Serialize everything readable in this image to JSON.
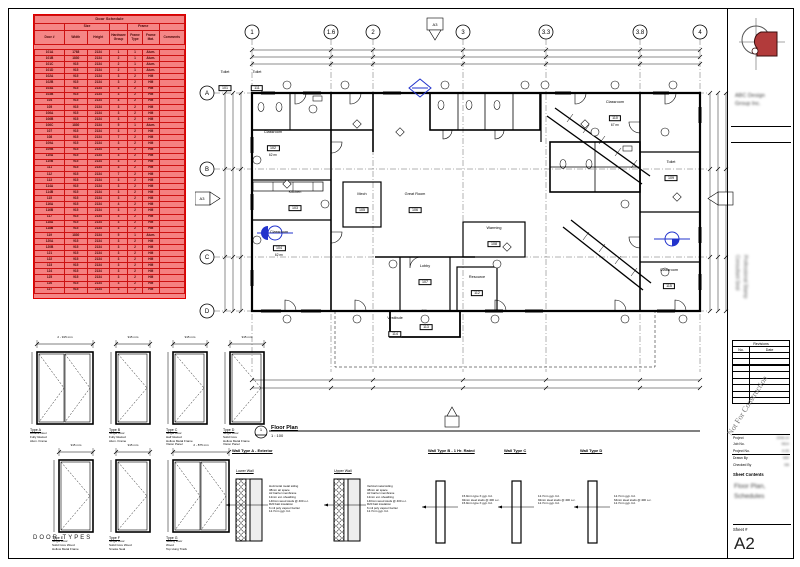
{
  "colors": {
    "schedule_fill": "#f58080",
    "schedule_border": "#e00000",
    "logo_red": "#b23b3b",
    "callout_blue": "#2233cc",
    "watermark_gray": "#777777"
  },
  "door_schedule": {
    "title": "Door Schedule",
    "groups": {
      "size": "Size",
      "frame": "Frame"
    },
    "columns": [
      "Door #",
      "Width",
      "Height",
      "Hardware Group",
      "Frame Type",
      "Frame Mat.",
      "Comments"
    ],
    "rows": [
      [
        "101A",
        "1768",
        "2134",
        "1",
        "1",
        "Alum.",
        ""
      ],
      [
        "101B",
        "1830",
        "2134",
        "2",
        "1",
        "Alum.",
        ""
      ],
      [
        "101C",
        "915",
        "2134",
        "2",
        "1",
        "Alum.",
        ""
      ],
      [
        "101D",
        "915",
        "2134",
        "2",
        "1",
        "Alum.",
        ""
      ],
      [
        "102A",
        "915",
        "2134",
        "3",
        "2",
        "HM",
        ""
      ],
      [
        "102B",
        "915",
        "2134",
        "3",
        "2",
        "HM",
        ""
      ],
      [
        "103A",
        "915",
        "2134",
        "3",
        "2",
        "HM",
        ""
      ],
      [
        "103B",
        "915",
        "2134",
        "3",
        "2",
        "HM",
        ""
      ],
      [
        "104",
        "915",
        "2134",
        "4",
        "2",
        "HM",
        ""
      ],
      [
        "105",
        "915",
        "2134",
        "3",
        "2",
        "HM",
        ""
      ],
      [
        "106A",
        "915",
        "2134",
        "3",
        "2",
        "HM",
        ""
      ],
      [
        "106B",
        "915",
        "2134",
        "3",
        "2",
        "HM",
        ""
      ],
      [
        "106C",
        "1830",
        "2134",
        "5",
        "1",
        "Alum.",
        ""
      ],
      [
        "107",
        "915",
        "2134",
        "3",
        "2",
        "HM",
        ""
      ],
      [
        "108",
        "915",
        "2134",
        "7",
        "2",
        "HM",
        ""
      ],
      [
        "109A",
        "915",
        "2134",
        "3",
        "2",
        "HM",
        ""
      ],
      [
        "109B",
        "915",
        "2134",
        "3",
        "2",
        "HM",
        ""
      ],
      [
        "110A",
        "915",
        "2134",
        "3",
        "2",
        "HM",
        ""
      ],
      [
        "110B",
        "915",
        "2134",
        "3",
        "2",
        "HM",
        ""
      ],
      [
        "111",
        "915",
        "2134",
        "3",
        "2",
        "HM",
        ""
      ],
      [
        "112",
        "915",
        "2134",
        "7",
        "2",
        "HM",
        ""
      ],
      [
        "113",
        "915",
        "2134",
        "3",
        "2",
        "HM",
        ""
      ],
      [
        "114A",
        "915",
        "2134",
        "3",
        "2",
        "HM",
        ""
      ],
      [
        "114B",
        "915",
        "2134",
        "3",
        "2",
        "HM",
        ""
      ],
      [
        "115",
        "915",
        "2134",
        "3",
        "2",
        "HM",
        ""
      ],
      [
        "116A",
        "915",
        "2134",
        "4",
        "2",
        "HM",
        ""
      ],
      [
        "116B",
        "915",
        "2134",
        "3",
        "2",
        "HM",
        ""
      ],
      [
        "117",
        "915",
        "2134",
        "3",
        "2",
        "HM",
        ""
      ],
      [
        "118A",
        "915",
        "2134",
        "3",
        "2",
        "HM",
        ""
      ],
      [
        "118B",
        "915",
        "2134",
        "3",
        "2",
        "HM",
        ""
      ],
      [
        "119",
        "1830",
        "2134",
        "5",
        "1",
        "Alum.",
        ""
      ],
      [
        "120A",
        "915",
        "2134",
        "3",
        "2",
        "HM",
        ""
      ],
      [
        "120B",
        "915",
        "2134",
        "3",
        "2",
        "HM",
        ""
      ],
      [
        "121",
        "915",
        "2134",
        "3",
        "2",
        "HM",
        ""
      ],
      [
        "122",
        "915",
        "2134",
        "3",
        "2",
        "HM",
        ""
      ],
      [
        "123",
        "915",
        "2134",
        "3",
        "2",
        "HM",
        ""
      ],
      [
        "124",
        "915",
        "2134",
        "3",
        "2",
        "HM",
        ""
      ],
      [
        "125",
        "915",
        "2134",
        "3",
        "2",
        "HM",
        ""
      ],
      [
        "126",
        "915",
        "2134",
        "3",
        "2",
        "HM",
        ""
      ],
      [
        "127",
        "915",
        "2134",
        "3",
        "2",
        "HM",
        ""
      ]
    ]
  },
  "floor_plan": {
    "grid_top": [
      {
        "label": "1",
        "x": 57
      },
      {
        "label": "1.6",
        "x": 136
      },
      {
        "label": "2",
        "x": 178
      },
      {
        "label": "3",
        "x": 268
      },
      {
        "label": "3.3",
        "x": 351
      },
      {
        "label": "3.8",
        "x": 445
      },
      {
        "label": "4",
        "x": 505
      }
    ],
    "grid_left": [
      {
        "label": "A",
        "y": 81
      },
      {
        "label": "B",
        "y": 157
      },
      {
        "label": "C",
        "y": 245
      },
      {
        "label": "D",
        "y": 299
      }
    ],
    "rooms": [
      {
        "name": "Toilet",
        "number": "101",
        "area": "",
        "x": 30,
        "y": 70
      },
      {
        "name": "Toilet",
        "number": "111",
        "area": "",
        "x": 62,
        "y": 70
      },
      {
        "name": "Classroom",
        "number": "102",
        "area": "62 m²",
        "x": 78,
        "y": 132
      },
      {
        "name": "Kitchen",
        "number": "103",
        "area": "",
        "x": 100,
        "y": 190
      },
      {
        "name": "Classroom",
        "number": "104",
        "area": "62 m²",
        "x": 84,
        "y": 232
      },
      {
        "name": "Mech",
        "number": "105",
        "area": "",
        "x": 167,
        "y": 192
      },
      {
        "name": "Great Room",
        "number": "106",
        "area": "",
        "x": 220,
        "y": 192
      },
      {
        "name": "Lobby",
        "number": "107",
        "area": "",
        "x": 230,
        "y": 264
      },
      {
        "name": "Warming",
        "number": "108",
        "area": "",
        "x": 299,
        "y": 226
      },
      {
        "name": "Resource",
        "number": "112",
        "area": "",
        "x": 282,
        "y": 275
      },
      {
        "name": "Office",
        "number": "113",
        "area": "",
        "x": 231,
        "y": 309
      },
      {
        "name": "Vestibule",
        "number": "114",
        "area": "",
        "x": 200,
        "y": 316
      },
      {
        "name": "Classroom",
        "number": "110",
        "area": "67 m²",
        "x": 420,
        "y": 102
      },
      {
        "name": "Toilet",
        "number": "109",
        "area": "",
        "x": 476,
        "y": 160
      },
      {
        "name": "Classroom",
        "number": "115",
        "area": "",
        "x": 474,
        "y": 268
      }
    ],
    "view_title": {
      "number": "1",
      "name": "Floor Plan",
      "scale": "1 : 100"
    },
    "section_tag": "A3"
  },
  "door_types": {
    "caption": "DOOR TYPES",
    "height_label": "2134 mm",
    "rows": [
      [
        {
          "label": "Type A",
          "dim": "2 - 915 mm",
          "leaves": 2,
          "desc": [
            "Double Door",
            "Fully Glazed",
            "Alum. Frame"
          ]
        },
        {
          "label": "Type B",
          "dim": "915 mm",
          "leaves": 1,
          "desc": [
            "Single Door",
            "Fully Glazed",
            "Alum. Frame"
          ]
        },
        {
          "label": "Type C",
          "dim": "915 mm",
          "leaves": 1,
          "desc": [
            "Single Door",
            "Half Glazed",
            "Hollow Metal Frame",
            "Vision Panel"
          ]
        },
        {
          "label": "Type D",
          "dim": "915 mm",
          "leaves": 1,
          "desc": [
            "Single Door",
            "Solid Core",
            "Hollow Metal Frame",
            "Vision Panel"
          ]
        }
      ],
      [
        {
          "label": "Type E",
          "dim": "915 mm",
          "leaves": 1,
          "desc": [
            "Single Door",
            "Solid Core Wood",
            "Hollow Metal Frame"
          ]
        },
        {
          "label": "Type F",
          "dim": "915 mm",
          "leaves": 1,
          "desc": [
            "Single Door",
            "Solid Core Wood",
            "Smoke Seal"
          ]
        },
        {
          "label": "Type G",
          "dim": "2 - 875 mm",
          "leaves": 2,
          "desc": [
            "Sliding Door",
            "Wood",
            "Top Hung Track"
          ]
        }
      ]
    ]
  },
  "wall_types": {
    "a": {
      "title": "Wall Type A - Exterior",
      "parts": [
        {
          "label": "Lower Wall",
          "notes": [
            "Horizontal metal siding",
            "38mm air space",
            "Air barrier membrane",
            "12mm ext. sheathing",
            "140mm wood studs @ 400 o.c.",
            "R20 batt insulation",
            "6 mil poly vapour barrier",
            "12.7mm gyp. bd."
          ]
        },
        {
          "label": "Upper Wall",
          "notes": [
            "Vertical metal siding",
            "38mm air space",
            "Air barrier membrane",
            "12mm ext. sheathing",
            "140mm wood studs @ 400 o.c.",
            "R20 batt insulation",
            "6 mil poly vapour barrier",
            "12.7mm gyp. bd."
          ]
        }
      ]
    },
    "others": [
      {
        "title": "Wall Type B - 1 Hr. Rated",
        "notes": [
          "15.9mm type X gyp. bd.",
          "92mm steel studs @ 400 o.c.",
          "15.9mm type X gyp. bd."
        ]
      },
      {
        "title": "Wall Type C",
        "notes": [
          "12.7mm gyp. bd.",
          "92mm steel studs @ 400 o.c.",
          "12.7mm gyp. bd."
        ]
      },
      {
        "title": "Wall Type D",
        "notes": [
          "12.7mm gyp. bd.",
          "64mm steel studs @ 400 o.c.",
          "12.7mm gyp. bd."
        ]
      }
    ]
  },
  "title_block": {
    "firm_lines": [
      "ABC Design",
      "Group Inc."
    ],
    "stamp_lines": [
      "Professional Stamp",
      "Consultant Seal"
    ],
    "revisions": {
      "title": "Revisions",
      "columns": [
        "No.",
        "Date"
      ],
      "empty_rows": 2,
      "extra_rows": 6
    },
    "watermark": "Not For Construction",
    "fields": [
      {
        "label": "Project",
        "value": "2006-14"
      },
      {
        "label": "Job No.",
        "value": "0614"
      },
      {
        "label": "Project No.",
        "value": "A-06"
      },
      {
        "label": "Drawn By",
        "value": "MW"
      },
      {
        "label": "Checked By",
        "value": "DB"
      }
    ],
    "sheet_contents_label": "Sheet Contents",
    "sheet_contents": [
      "Floor Plan,",
      "Schedules"
    ],
    "sheet_number_label": "Sheet #",
    "sheet_number": "A2"
  }
}
